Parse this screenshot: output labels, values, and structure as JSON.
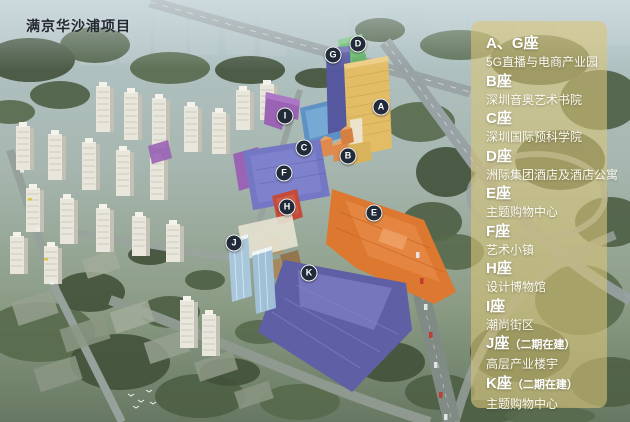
{
  "title": "满京华沙浦项目",
  "legend": {
    "entries": [
      {
        "building": "A、G座",
        "suffix": "",
        "desc": "5G直播与电商产业园"
      },
      {
        "building": "B座",
        "suffix": "",
        "desc": "深圳音奥艺术书院"
      },
      {
        "building": "C座",
        "suffix": "",
        "desc": "深圳国际预科学院"
      },
      {
        "building": "D座",
        "suffix": "",
        "desc": "洲际集团酒店及酒店公寓"
      },
      {
        "building": "E座",
        "suffix": "",
        "desc": "主题购物中心"
      },
      {
        "building": "F座",
        "suffix": "",
        "desc": "艺术小镇"
      },
      {
        "building": "H座",
        "suffix": "",
        "desc": "设计博物馆"
      },
      {
        "building": "I座",
        "suffix": "",
        "desc": "潮尚街区"
      },
      {
        "building": "J座",
        "suffix": "（二期在建）",
        "desc": "高层产业楼宇"
      },
      {
        "building": "K座",
        "suffix": "（二期在建）",
        "desc": "主题购物中心"
      }
    ]
  },
  "markers": [
    {
      "letter": "D",
      "x": 358,
      "y": 44
    },
    {
      "letter": "G",
      "x": 333,
      "y": 55
    },
    {
      "letter": "A",
      "x": 381,
      "y": 107
    },
    {
      "letter": "I",
      "x": 285,
      "y": 116
    },
    {
      "letter": "C",
      "x": 304,
      "y": 148
    },
    {
      "letter": "B",
      "x": 348,
      "y": 156
    },
    {
      "letter": "F",
      "x": 284,
      "y": 173
    },
    {
      "letter": "H",
      "x": 287,
      "y": 207
    },
    {
      "letter": "E",
      "x": 374,
      "y": 213
    },
    {
      "letter": "J",
      "x": 234,
      "y": 243
    },
    {
      "letter": "K",
      "x": 309,
      "y": 273
    }
  ],
  "colors": {
    "building_A": "#e3bd66",
    "building_B": "#dd8a4c",
    "building_C": "#5e92c5",
    "building_D": "#68ba6d",
    "building_E": "#dd7830",
    "building_F": "#7478c4",
    "building_G": "#56589f",
    "building_H": "#c44a3a",
    "building_I": "#9a63b4",
    "building_J": "#a9c7dc",
    "building_K": "#5e5fa4",
    "legend_panel": "#d8c478",
    "marker_bg": "#222b39",
    "marker_text": "#ffffff",
    "legend_text": "#ffffff",
    "title_text": "#232832"
  }
}
